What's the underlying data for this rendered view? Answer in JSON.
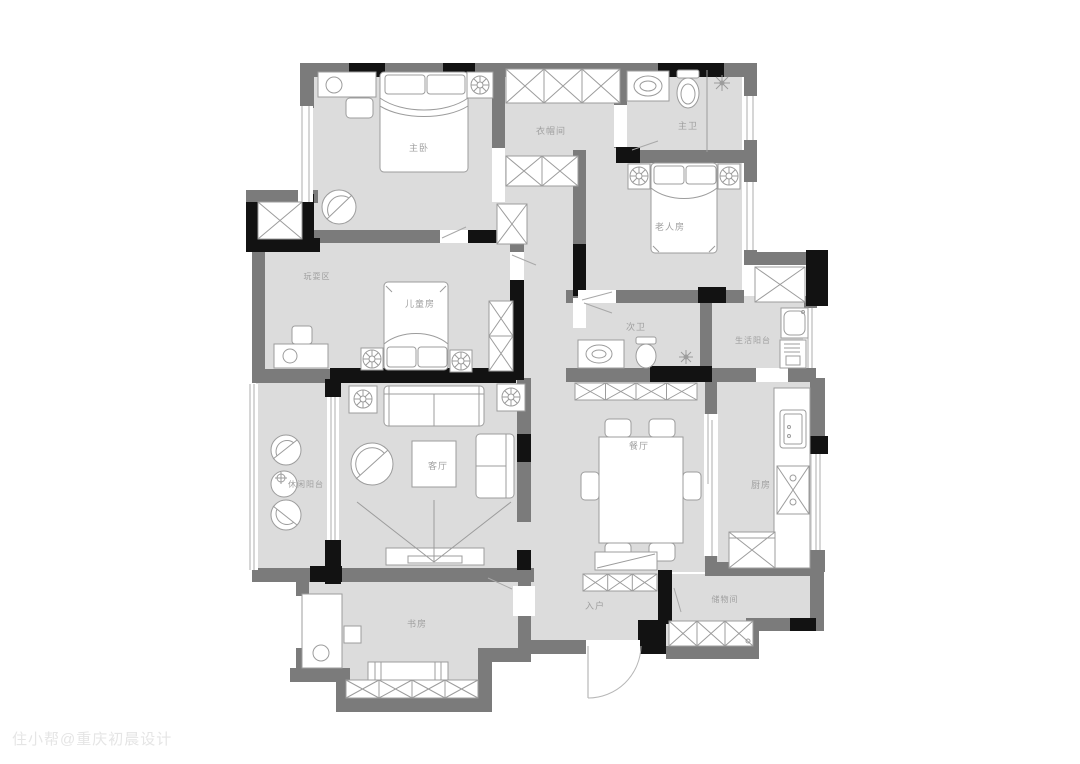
{
  "plan_type": "residential-floor-plan",
  "labels": {
    "master_bedroom": "主卧",
    "cloakroom": "衣帽间",
    "master_bath": "主卫",
    "elder_room": "老人房",
    "play_area": "玩耍区",
    "kids_room": "儿童房",
    "second_bath": "次卫",
    "utility_balcony": "生活阳台",
    "dining_room": "餐厅",
    "kitchen": "厨房",
    "living_room": "客厅",
    "leisure_balcony": "休闲阳台",
    "study": "书房",
    "entry": "入户",
    "storage": "储物间"
  },
  "watermark": "住小帮@重庆初晨设计",
  "colors": {
    "floor": "#dcdcdc",
    "wall": "#7b7b7b",
    "wall_accent": "#121212",
    "furniture_line": "#9c9c9c",
    "label_text": "#9f9f9f",
    "watermark_text": "#e5e5e5",
    "background": "#ffffff"
  }
}
